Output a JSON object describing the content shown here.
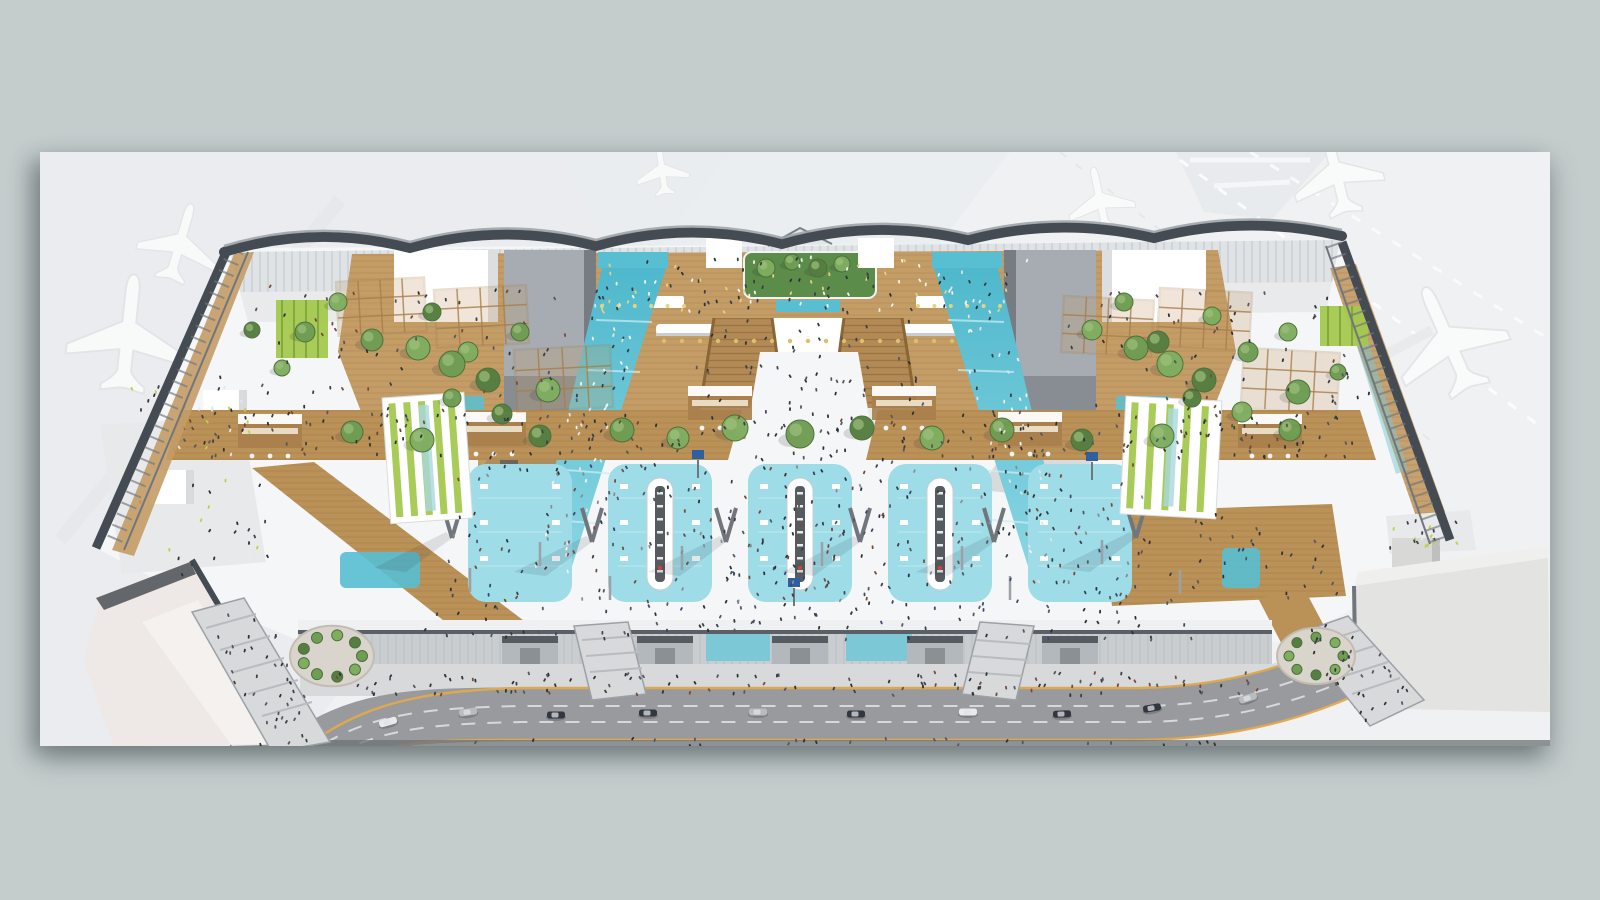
{
  "meta": {
    "type": "architectural-rendering",
    "subject": "aerial cutaway rendering of an airport terminal departures hall with mezzanine, teal ramps, check-in islands and curbside road",
    "backdrop": "faded airport apron with parked aircraft and piers"
  },
  "palette": {
    "bg": "#c4cdcc",
    "apron": "#f0f1f2",
    "apronBand": "#e9ebee",
    "steelDark": "#454b52",
    "steelMid": "#70767c",
    "steelLight": "#9ba1a6",
    "glass": "#dde2e5",
    "mullion": "#b7bdc2",
    "floor": "#f5f6f7",
    "floorShade": "#e7e9eb",
    "wood": "#c49c66",
    "woodDark": "#a87f4b",
    "woodDeck": "#ba9157",
    "woodStair": "#b38a55",
    "tealRamp": "#58bfd3",
    "tealLight": "#8fd9e5",
    "tealZone": "#9edce7",
    "tealGlass": "#7cc8d6",
    "green": "#6f9d53",
    "greenDark": "#557e3f",
    "greenBright": "#a4c84e",
    "monolith": "#a6acb1",
    "monolithShade": "#878d93",
    "island": "#565b60",
    "red": "#d84a3f",
    "screen": "#2f5f9e",
    "facade": "#c9cdd0",
    "canopy": "#b3b8bc",
    "canopyTop": "#555b61",
    "road": "#989a9d",
    "roadDash": "#d6d8da",
    "yellow": "#dfa94e",
    "sidewalk": "#d7d9db",
    "curbDark": "#6e7276",
    "pierLite": "#eee8e6",
    "pierRight": "#e3e3e1",
    "carDark": "#31363f",
    "carSilver": "#b9bcbf",
    "carWhite": "#e8eaeb",
    "planeFill": "#fafbfb",
    "planeEdge": "#e2e5e7"
  },
  "panel": {
    "x": 40,
    "y": 152,
    "w": 1510,
    "h": 594
  },
  "decor": {
    "planes": [
      {
        "x": 180,
        "y": 243,
        "rot": 16,
        "s": 0.85
      },
      {
        "x": 128,
        "y": 334,
        "rot": 6,
        "s": 1.25
      },
      {
        "x": 1336,
        "y": 172,
        "rot": -14,
        "s": 0.95
      },
      {
        "x": 1448,
        "y": 340,
        "rot": -24,
        "s": 1.2
      },
      {
        "x": 1100,
        "y": 200,
        "rot": -12,
        "s": 0.7
      },
      {
        "x": 662,
        "y": 170,
        "rot": -8,
        "s": 0.55
      }
    ],
    "zones": {
      "y": 464,
      "h": 138,
      "w": 104,
      "rx": 18,
      "xs": [
        468,
        608,
        748,
        888,
        1028
      ]
    },
    "islands": {
      "xs": [
        660,
        800,
        940
      ],
      "y": 478,
      "h": 112
    },
    "canopies": {
      "xs": [
        530,
        665,
        800,
        935,
        1070
      ],
      "y": 636,
      "w": 56,
      "h": 34
    },
    "kiosks": [
      {
        "x": 238,
        "y": 414
      },
      {
        "x": 462,
        "y": 412
      },
      {
        "x": 688,
        "y": 386
      },
      {
        "x": 872,
        "y": 386
      },
      {
        "x": 998,
        "y": 412
      },
      {
        "x": 1238,
        "y": 414
      }
    ],
    "vcolumns": [
      [
        592,
        542
      ],
      [
        726,
        542
      ],
      [
        860,
        542
      ],
      [
        994,
        542
      ],
      [
        452,
        538
      ],
      [
        1136,
        538
      ]
    ],
    "poles": [
      [
        540,
        566
      ],
      [
        682,
        570
      ],
      [
        822,
        566
      ],
      [
        962,
        570
      ],
      [
        1102,
        564
      ],
      [
        470,
        592
      ],
      [
        1180,
        594
      ],
      [
        610,
        600
      ],
      [
        1010,
        600
      ]
    ],
    "screens": [
      [
        794,
        606
      ],
      [
        1092,
        480
      ],
      [
        698,
        478
      ]
    ],
    "dotrows": [
      {
        "x0": 664,
        "x1": 952,
        "y": 341,
        "n": 17,
        "c": "#dbc06c",
        "r": 2.2
      },
      {
        "x0": 602,
        "x1": 684,
        "y": 306,
        "n": 6,
        "c": "#e8d27e",
        "r": 2
      },
      {
        "x0": 918,
        "x1": 1000,
        "y": 306,
        "n": 6,
        "c": "#e8d27e",
        "r": 2
      }
    ],
    "pergolas": [
      [
        336,
        282,
        88,
        54,
        -3
      ],
      [
        434,
        290,
        92,
        58,
        -3
      ],
      [
        514,
        350,
        96,
        62,
        -3
      ],
      [
        1064,
        296,
        90,
        56,
        3
      ],
      [
        1160,
        288,
        92,
        58,
        3
      ],
      [
        1244,
        348,
        96,
        60,
        3
      ]
    ],
    "striped_pavilions": [
      {
        "x": 382,
        "y": 398,
        "w": 82,
        "h": 126,
        "rot": -4,
        "strips": 5,
        "dir": "v"
      },
      {
        "x": 1126,
        "y": 396,
        "w": 96,
        "h": 118,
        "rot": 3,
        "strips": 5,
        "dir": "v"
      }
    ],
    "trees": [
      [
        305,
        332,
        10,
        0
      ],
      [
        338,
        302,
        9,
        1
      ],
      [
        372,
        340,
        11,
        0
      ],
      [
        432,
        312,
        9,
        2
      ],
      [
        468,
        352,
        10,
        1
      ],
      [
        520,
        332,
        9,
        0
      ],
      [
        548,
        390,
        12,
        1
      ],
      [
        502,
        414,
        10,
        2
      ],
      [
        452,
        398,
        9,
        0
      ],
      [
        282,
        368,
        8,
        1
      ],
      [
        252,
        330,
        8,
        2
      ],
      [
        418,
        348,
        12,
        1
      ],
      [
        452,
        364,
        13,
        0
      ],
      [
        488,
        380,
        12,
        2
      ],
      [
        1092,
        330,
        10,
        1
      ],
      [
        1124,
        302,
        9,
        0
      ],
      [
        1158,
        342,
        11,
        2
      ],
      [
        1212,
        316,
        9,
        1
      ],
      [
        1248,
        352,
        10,
        0
      ],
      [
        1288,
        332,
        9,
        1
      ],
      [
        1298,
        392,
        12,
        0
      ],
      [
        1242,
        412,
        10,
        1
      ],
      [
        1192,
        398,
        9,
        2
      ],
      [
        1338,
        372,
        8,
        0
      ],
      [
        1136,
        348,
        12,
        0
      ],
      [
        1170,
        364,
        13,
        1
      ],
      [
        1204,
        380,
        12,
        2
      ],
      [
        766,
        268,
        9,
        1
      ],
      [
        792,
        262,
        8,
        0
      ],
      [
        818,
        268,
        9,
        2
      ],
      [
        842,
        264,
        8,
        1
      ],
      [
        352,
        432,
        11,
        0
      ],
      [
        422,
        440,
        12,
        1
      ],
      [
        540,
        436,
        11,
        2
      ],
      [
        622,
        430,
        12,
        0
      ],
      [
        678,
        438,
        11,
        1
      ],
      [
        932,
        438,
        12,
        1
      ],
      [
        1002,
        430,
        12,
        0
      ],
      [
        1082,
        440,
        11,
        2
      ],
      [
        1162,
        436,
        12,
        1
      ],
      [
        1290,
        430,
        11,
        0
      ],
      [
        735,
        428,
        13,
        1
      ],
      [
        800,
        434,
        14,
        0
      ],
      [
        862,
        428,
        12,
        2
      ]
    ],
    "planter_rings": [
      {
        "cx": 332,
        "cy": 656,
        "R": 30,
        "n": 9,
        "r": 5.5
      },
      {
        "cx": 1316,
        "cy": 656,
        "R": 27,
        "n": 8,
        "r": 5
      }
    ],
    "cars": [
      [
        468,
        712,
        -8,
        "carSilver"
      ],
      [
        556,
        715,
        0,
        "carDark"
      ],
      [
        648,
        713,
        0,
        "carDark"
      ],
      [
        758,
        712,
        0,
        "carSilver"
      ],
      [
        856,
        714,
        0,
        "carDark"
      ],
      [
        968,
        712,
        0,
        "carWhite"
      ],
      [
        1062,
        714,
        -2,
        "carDark"
      ],
      [
        1152,
        708,
        -10,
        "carDark"
      ],
      [
        1248,
        698,
        -18,
        "carSilver"
      ],
      [
        1338,
        674,
        -26,
        "carDark"
      ],
      [
        1414,
        646,
        -30,
        "carDark"
      ],
      [
        388,
        722,
        -16,
        "carWhite"
      ]
    ],
    "people_regions": [
      {
        "poly": [
          [
            735,
            330
          ],
          [
            865,
            330
          ],
          [
            905,
            618
          ],
          [
            695,
            618
          ]
        ],
        "n": 80,
        "cols": [
          "#2e3237",
          "#3c3f45",
          "#55585e",
          "#7a4a3a",
          "#3a4a6b"
        ]
      },
      {
        "poly": [
          [
            455,
            462
          ],
          [
            1140,
            462
          ],
          [
            1150,
            602
          ],
          [
            445,
            602
          ]
        ],
        "n": 250,
        "cols": [
          "#2e3237",
          "#3c3f45",
          "#55585e",
          "#7a4a3a",
          "#3a4a6b",
          "#8a8d91"
        ]
      },
      {
        "poly": [
          [
            430,
            602
          ],
          [
            1185,
            602
          ],
          [
            1195,
            640
          ],
          [
            420,
            640
          ]
        ],
        "n": 85,
        "cols": [
          "#2e3237",
          "#3c3f45",
          "#55585e",
          "#3a4a6b"
        ]
      },
      {
        "poly": [
          [
            335,
            672
          ],
          [
            1265,
            672
          ],
          [
            1265,
            696
          ],
          [
            335,
            696
          ]
        ],
        "n": 120,
        "cols": [
          "#2e3237",
          "#3c3f45",
          "#55585e",
          "#7a4a3a"
        ]
      },
      {
        "poly": [
          [
            180,
            412
          ],
          [
            732,
            412
          ],
          [
            720,
            458
          ],
          [
            168,
            458
          ]
        ],
        "n": 85,
        "cols": [
          "#2e3237",
          "#3c3f45",
          "#6b4a35",
          "#55585e"
        ]
      },
      {
        "poly": [
          [
            880,
            412
          ],
          [
            1358,
            412
          ],
          [
            1372,
            458
          ],
          [
            868,
            458
          ]
        ],
        "n": 85,
        "cols": [
          "#2e3237",
          "#3c3f45",
          "#6b4a35",
          "#55585e"
        ]
      },
      {
        "poly": [
          [
            592,
            256
          ],
          [
            1028,
            256
          ],
          [
            1016,
            314
          ],
          [
            602,
            314
          ]
        ],
        "n": 110,
        "cols": [
          "#2e3237",
          "#e6cf7f",
          "#f2f3f4",
          "#3c3f45"
        ]
      },
      {
        "poly": [
          [
            602,
            268
          ],
          [
            664,
            268
          ],
          [
            562,
            596
          ],
          [
            528,
            590
          ]
        ],
        "n": 55,
        "cols": [
          "#f2f4f5",
          "#dfe3e5",
          "#3c3f45"
        ]
      },
      {
        "poly": [
          [
            936,
            268
          ],
          [
            998,
            268
          ],
          [
            1072,
            590
          ],
          [
            1038,
            596
          ]
        ],
        "n": 55,
        "cols": [
          "#f2f4f5",
          "#dfe3e5",
          "#3c3f45"
        ]
      },
      {
        "poly": [
          [
            250,
            282
          ],
          [
            560,
            282
          ],
          [
            600,
            428
          ],
          [
            240,
            428
          ]
        ],
        "n": 70,
        "cols": [
          "#2e3237",
          "#3c3f45",
          "#55585e",
          "#7a4a3a"
        ]
      },
      {
        "poly": [
          [
            1062,
            292
          ],
          [
            1338,
            292
          ],
          [
            1388,
            448
          ],
          [
            1082,
            448
          ]
        ],
        "n": 70,
        "cols": [
          "#2e3237",
          "#3c3f45",
          "#55585e",
          "#7a4a3a"
        ]
      },
      {
        "poly": [
          [
            120,
            380
          ],
          [
            250,
            372
          ],
          [
            280,
            570
          ],
          [
            150,
            585
          ]
        ],
        "n": 60,
        "cols": [
          "#b9d24e",
          "#e5e7e9",
          "#3c3f45",
          "#2e3237"
        ]
      },
      {
        "poly": [
          [
            1105,
            515
          ],
          [
            1328,
            508
          ],
          [
            1342,
            596
          ],
          [
            1115,
            604
          ]
        ],
        "n": 40,
        "cols": [
          "#2e3237",
          "#3c3f45",
          "#55585e"
        ]
      },
      {
        "poly": [
          [
            205,
            615
          ],
          [
            260,
            602
          ],
          [
            330,
            744
          ],
          [
            258,
            748
          ]
        ],
        "n": 40,
        "cols": [
          "#2e3237",
          "#3c3f45",
          "#55585e"
        ]
      },
      {
        "poly": [
          [
            1296,
            634
          ],
          [
            1350,
            618
          ],
          [
            1420,
            700
          ],
          [
            1365,
            726
          ]
        ],
        "n": 35,
        "cols": [
          "#2e3237",
          "#3c3f45",
          "#55585e"
        ]
      },
      {
        "poly": [
          [
            700,
            320
          ],
          [
            920,
            320
          ],
          [
            930,
            455
          ],
          [
            690,
            455
          ]
        ],
        "n": 50,
        "cols": [
          "#2e3237",
          "#3c3f45",
          "#55585e"
        ]
      },
      {
        "poly": [
          [
            1388,
            520
          ],
          [
            1468,
            520
          ],
          [
            1468,
            548
          ],
          [
            1388,
            548
          ]
        ],
        "n": 25,
        "cols": [
          "#b9d24e",
          "#e5e7e9",
          "#3c3f45"
        ]
      },
      {
        "poly": [
          [
            430,
            738
          ],
          [
            1230,
            738
          ],
          [
            1230,
            746
          ],
          [
            430,
            746
          ]
        ],
        "n": 25,
        "cols": [
          "#2e3237",
          "#55585e"
        ]
      }
    ]
  }
}
